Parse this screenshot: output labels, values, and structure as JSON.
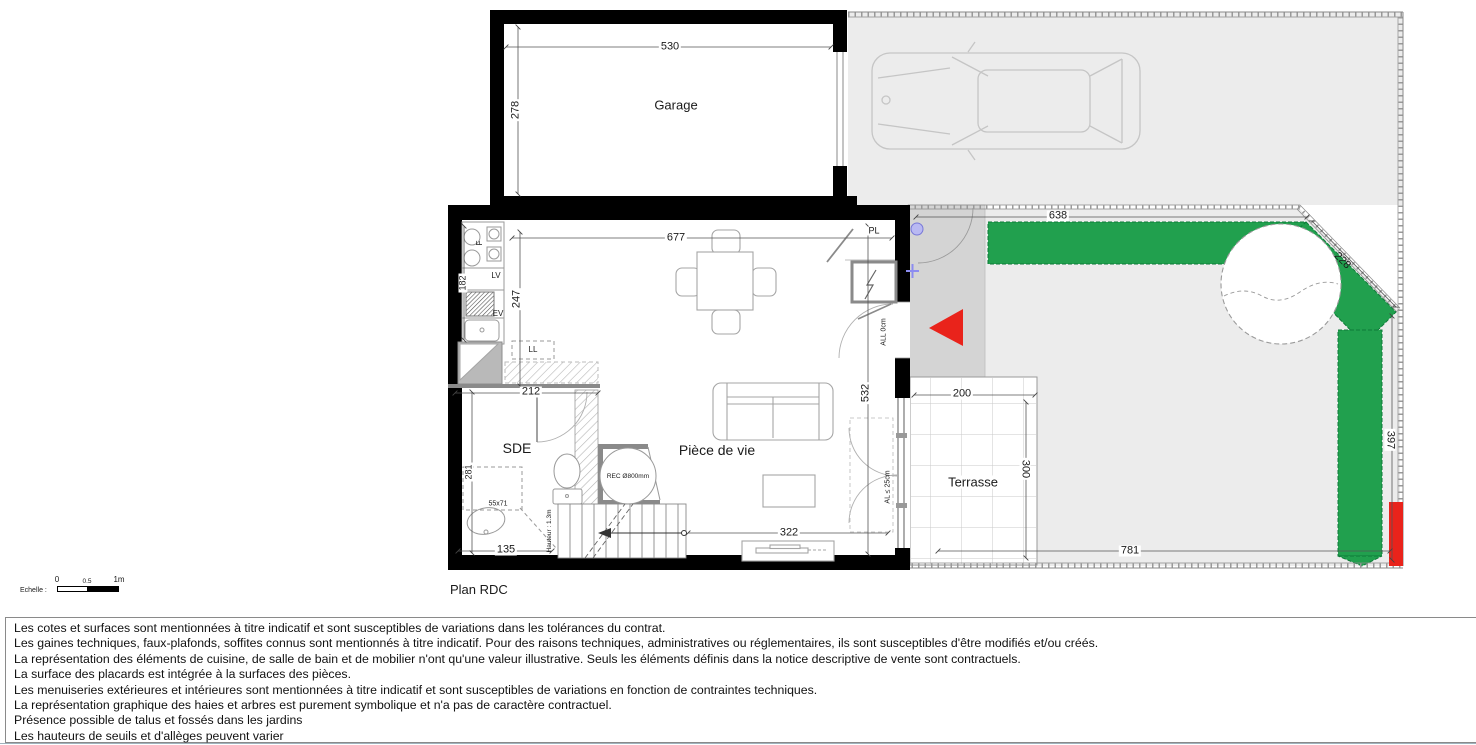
{
  "plan": {
    "title": "Plan RDC",
    "rooms": {
      "garage": "Garage",
      "living": "Pièce de vie",
      "sde": "SDE",
      "terrace": "Terrasse"
    },
    "dims": {
      "d530": "530",
      "d278": "278",
      "d677": "677",
      "d247": "247",
      "d182": "182",
      "d212": "212",
      "d281": "281",
      "d135": "135",
      "d322": "322",
      "d532": "532",
      "d638": "638",
      "d228": "228",
      "d397": "397",
      "d781": "781",
      "d200": "200",
      "d300": "300"
    },
    "annotations": {
      "pl": "PL",
      "f": "F",
      "lv": "LV",
      "ev": "EV",
      "ll": "LL",
      "sink_size": "55x71",
      "shower": "REC Ø800mm",
      "all0": "ALL 0cm",
      "al25": "AL ≤ 25cm",
      "stair_note": "Hauteur : 1.3m"
    },
    "scale_bar": {
      "label": "Echelle :",
      "tick0": "0",
      "tick05": "0.5",
      "tick1": "1m"
    }
  },
  "disclaimer": {
    "lines": [
      "Les cotes et surfaces sont mentionnées à titre indicatif et sont susceptibles de variations dans les tolérances du contrat.",
      "Les gaines techniques, faux-plafonds, soffites connus sont mentionnés à titre indicatif. Pour des raisons techniques, administratives ou réglementaires, ils sont susceptibles d'être modifiés et/ou créés.",
      "La représentation des éléments de cuisine, de salle de bain et de mobilier n'ont qu'une valeur illustrative. Seuls les éléments définis dans la notice descriptive de vente sont contractuels.",
      "La surface des placards est intégrée à la surfaces des pièces.",
      "Les menuiseries extérieures et intérieures sont mentionnées à titre indicatif et sont susceptibles de variations en fonction de contraintes techniques.",
      "La représentation graphique des haies et arbres est purement symbolique et n'a pas de caractère contractuel.",
      "Présence possible de talus et fossés dans les jardins",
      "Les hauteurs de seuils et d'allèges peuvent varier"
    ]
  },
  "colors": {
    "site_gray": "#ececec",
    "porch_gray": "#d4d4d4",
    "hedge_green": "#21a04e",
    "marker_red": "#e9231b",
    "symbol_blue": "#9a9aee",
    "wall_black": "#000000"
  }
}
